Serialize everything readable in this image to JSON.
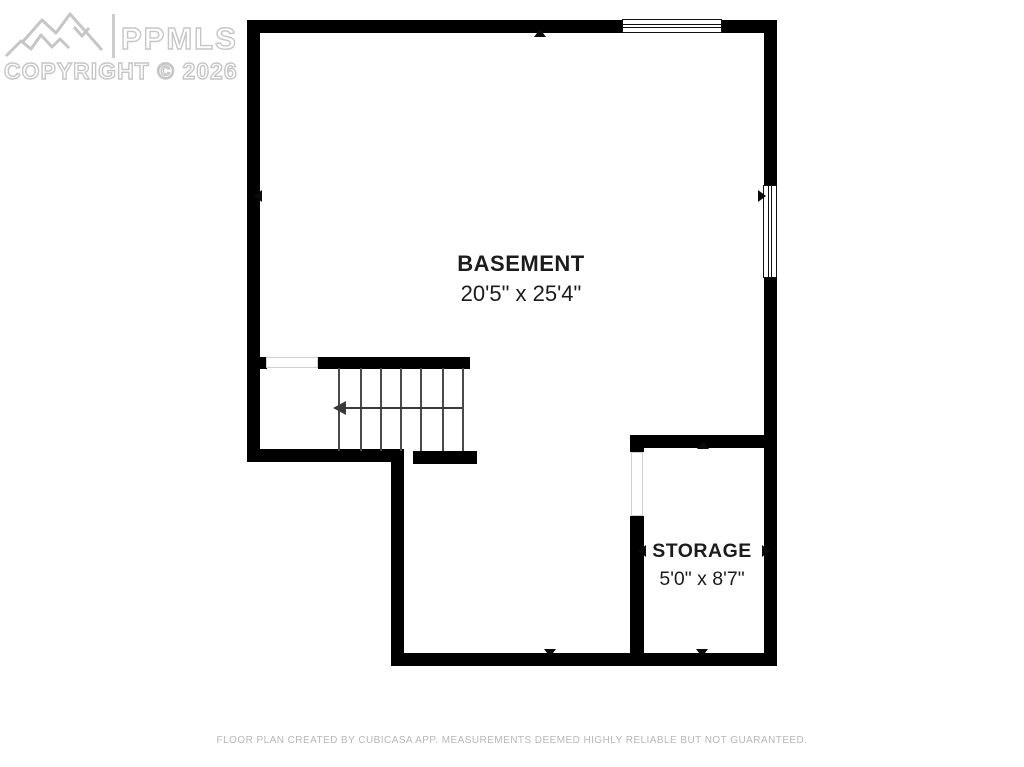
{
  "watermark": {
    "brand": "PPMLS",
    "copyright": "COPYRIGHT © 2026",
    "logo": "mountain-range-icon",
    "color": "#c6c6c6"
  },
  "floor_plan": {
    "rooms": [
      {
        "name": "BASEMENT",
        "dimensions": "20'5\" x 25'4\""
      },
      {
        "name": "STORAGE",
        "dimensions": "5'0\" x 8'7\""
      }
    ],
    "features": {
      "windows": 2,
      "stair_steps": 7,
      "stair_direction_icon": "left-arrow",
      "wall_marker_icon": "small-triangle"
    },
    "colors": {
      "walls": "#000000",
      "room_text": "#1c1c1c",
      "opening_outline": "#cfcfcf"
    }
  },
  "footer": {
    "disclaimer": "FLOOR PLAN CREATED BY CUBICASA APP. MEASUREMENTS DEEMED HIGHLY RELIABLE BUT NOT GUARANTEED."
  }
}
